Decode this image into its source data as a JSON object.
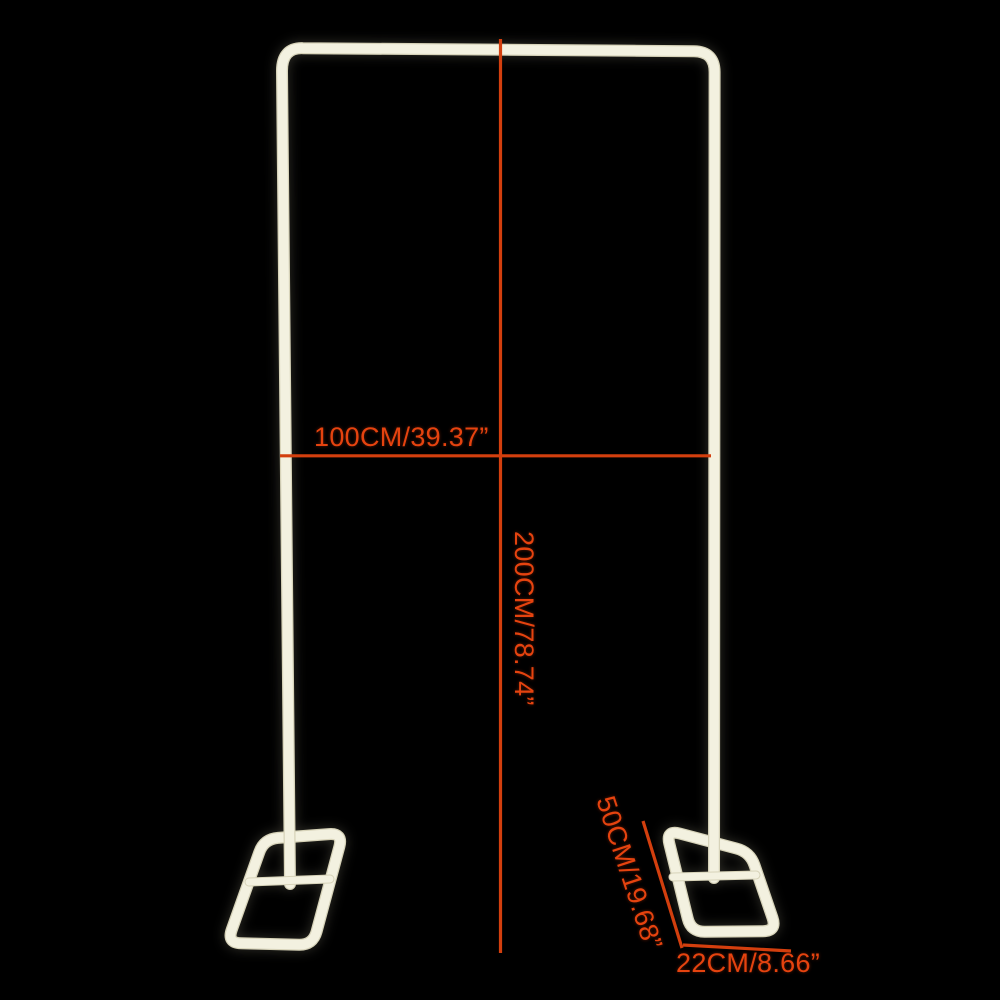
{
  "colors": {
    "background": "#000000",
    "frame": "#f3f1e0",
    "frame_edge": "#d7d3b9",
    "dimension_line": "#d33f0e",
    "dimension_text": "#e5430f"
  },
  "labels": {
    "width": "100CM/39.37”",
    "height": "200CM/78.74”",
    "base_depth": "50CM/19.68”",
    "base_width": "22CM/8.66”"
  }
}
